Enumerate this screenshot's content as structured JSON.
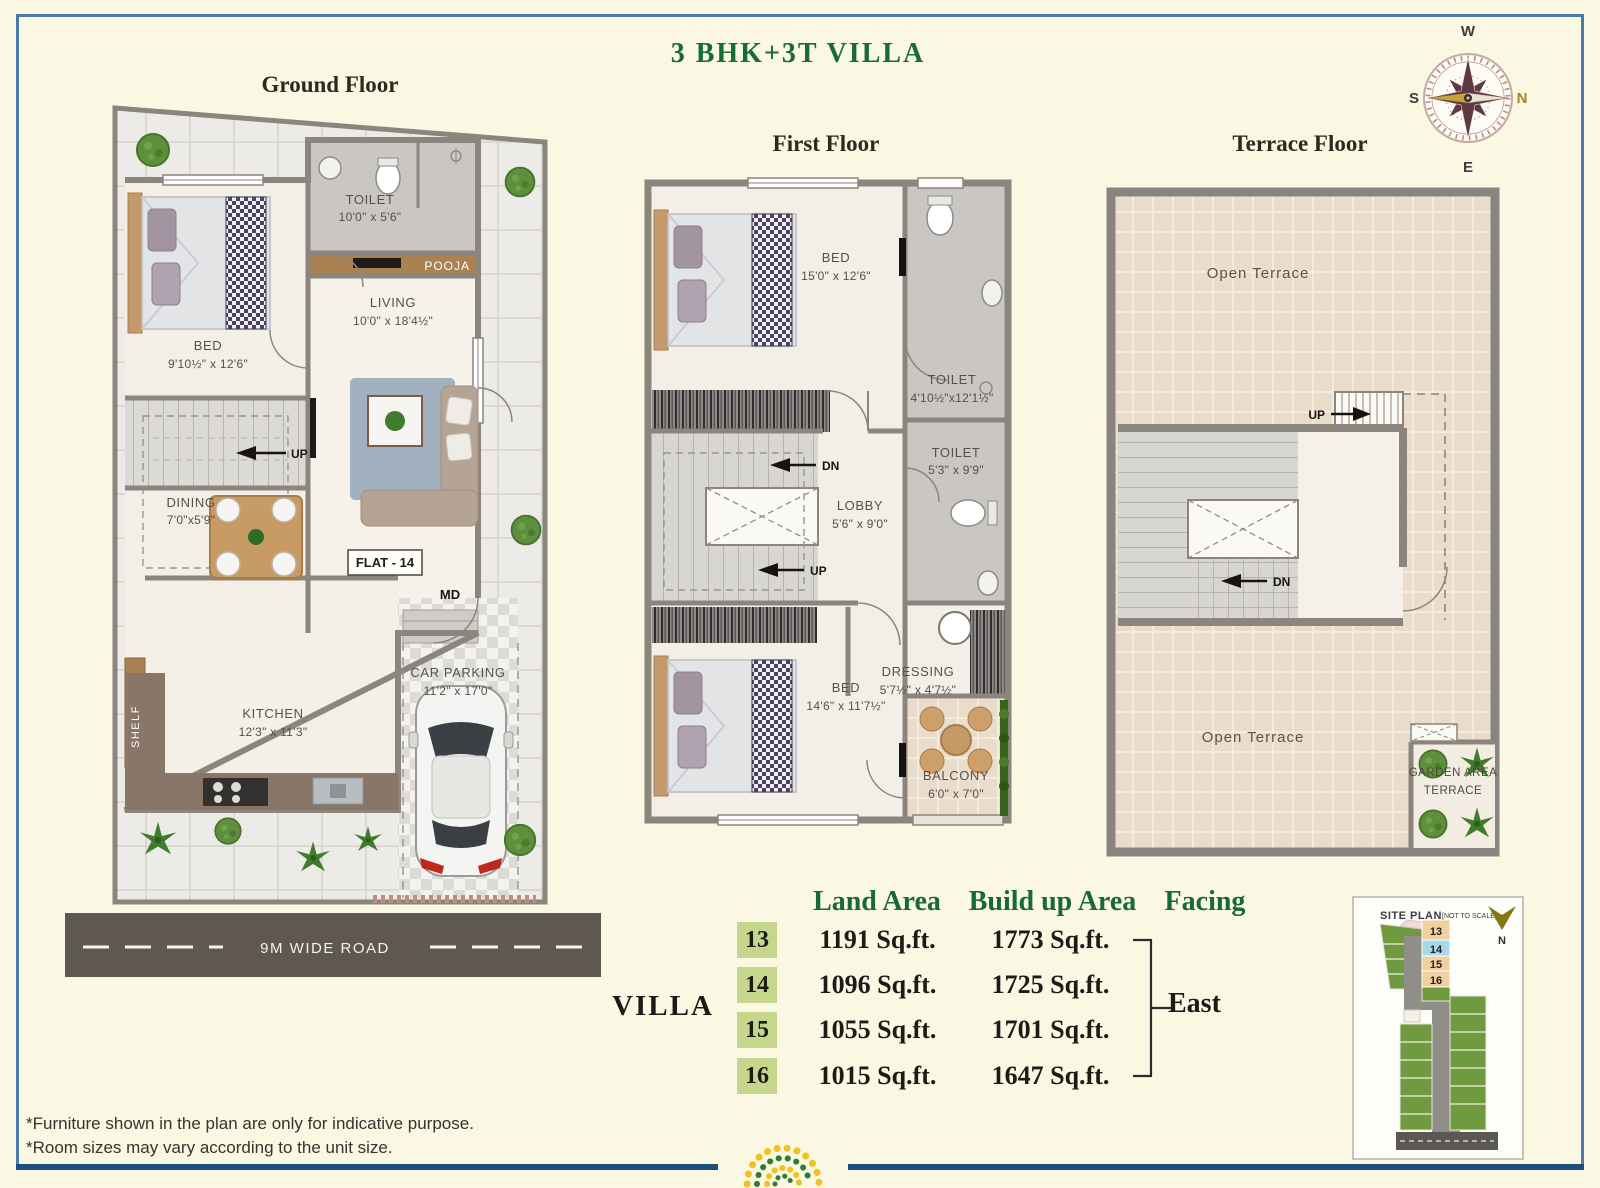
{
  "title": "3 BHK+3T VILLA",
  "compass": {
    "top": "W",
    "right": "N",
    "bottom": "E",
    "left": "S"
  },
  "ground_floor": {
    "heading": "Ground Floor",
    "bed": {
      "label": "BED",
      "dims": "9'10½\" x 12'6\""
    },
    "toilet": {
      "label": "TOILET",
      "dims": "10'0\" x 5'6\""
    },
    "pooja": {
      "label": "POOJA"
    },
    "living": {
      "label": "LIVING",
      "dims": "10'0\" x 18'4½\""
    },
    "stairs_up": {
      "label": "UP"
    },
    "dining": {
      "label": "DINING",
      "dims": "7'0\"x5'9\""
    },
    "flat": {
      "label": "FLAT - 14"
    },
    "main_door": {
      "label": "MD"
    },
    "shelf": {
      "label": "SHELF"
    },
    "kitchen": {
      "label": "KITCHEN",
      "dims": "12'3\" x 11'3\""
    },
    "car_parking": {
      "label": "CAR PARKING",
      "dims": "11'2\" x 17'0\""
    },
    "road": {
      "label": "9M WIDE ROAD"
    }
  },
  "first_floor": {
    "heading": "First Floor",
    "bed1": {
      "label": "BED",
      "dims": "15'0\" x 12'6\""
    },
    "toilet1": {
      "label": "TOILET",
      "dims": "4'10½\"x12'1½\""
    },
    "toilet2": {
      "label": "TOILET",
      "dims": "5'3\" x 9'9\""
    },
    "lobby": {
      "label": "LOBBY",
      "dims": "5'6\" x 9'0\""
    },
    "stairs_dn": {
      "label": "DN"
    },
    "stairs_up": {
      "label": "UP"
    },
    "dressing": {
      "label": "DRESSING",
      "dims": "5'7½\" x 4'7½\""
    },
    "bed2": {
      "label": "BED",
      "dims": "14'6\" x 11'7½\""
    },
    "balcony": {
      "label": "BALCONY",
      "dims": "6'0\" x 7'0\""
    }
  },
  "terrace_floor": {
    "heading": "Terrace Floor",
    "open_terrace_top": {
      "label": "Open Terrace"
    },
    "stairs_up": {
      "label": "UP"
    },
    "stairs_dn": {
      "label": "DN"
    },
    "open_terrace_bottom": {
      "label": "Open Terrace"
    },
    "garden": {
      "line1": "GARDEN AREA",
      "line2": "TERRACE"
    }
  },
  "area_table": {
    "row_header": "VILLA",
    "columns": [
      "Land Area",
      "Build up Area",
      "Facing"
    ],
    "rows": [
      {
        "villa": "13",
        "land": "1191 Sq.ft.",
        "build": "1773 Sq.ft."
      },
      {
        "villa": "14",
        "land": "1096 Sq.ft.",
        "build": "1725 Sq.ft."
      },
      {
        "villa": "15",
        "land": "1055 Sq.ft.",
        "build": "1701 Sq.ft."
      },
      {
        "villa": "16",
        "land": "1015 Sq.ft.",
        "build": "1647 Sq.ft."
      }
    ],
    "facing": "East"
  },
  "site_plan": {
    "title": "SITE PLAN",
    "scale_note": "[NOT TO SCALE]",
    "north": "N",
    "plots": [
      "13",
      "14",
      "15",
      "16"
    ],
    "highlighted_plot": "14"
  },
  "notes": [
    "*Furniture shown in the plan are only for indicative purpose.",
    "*Room sizes may vary according to the unit size."
  ],
  "colors": {
    "accent_green": "#176b35",
    "highlight_cell": "#c6d78d",
    "plot_tan": "#f2cf9e",
    "plot_highlight_blue": "#a8d8ea",
    "site_green": "#6f9a3f",
    "frame_blue": "#4b7aa6",
    "footer_bar_blue": "#1c4e7d"
  }
}
